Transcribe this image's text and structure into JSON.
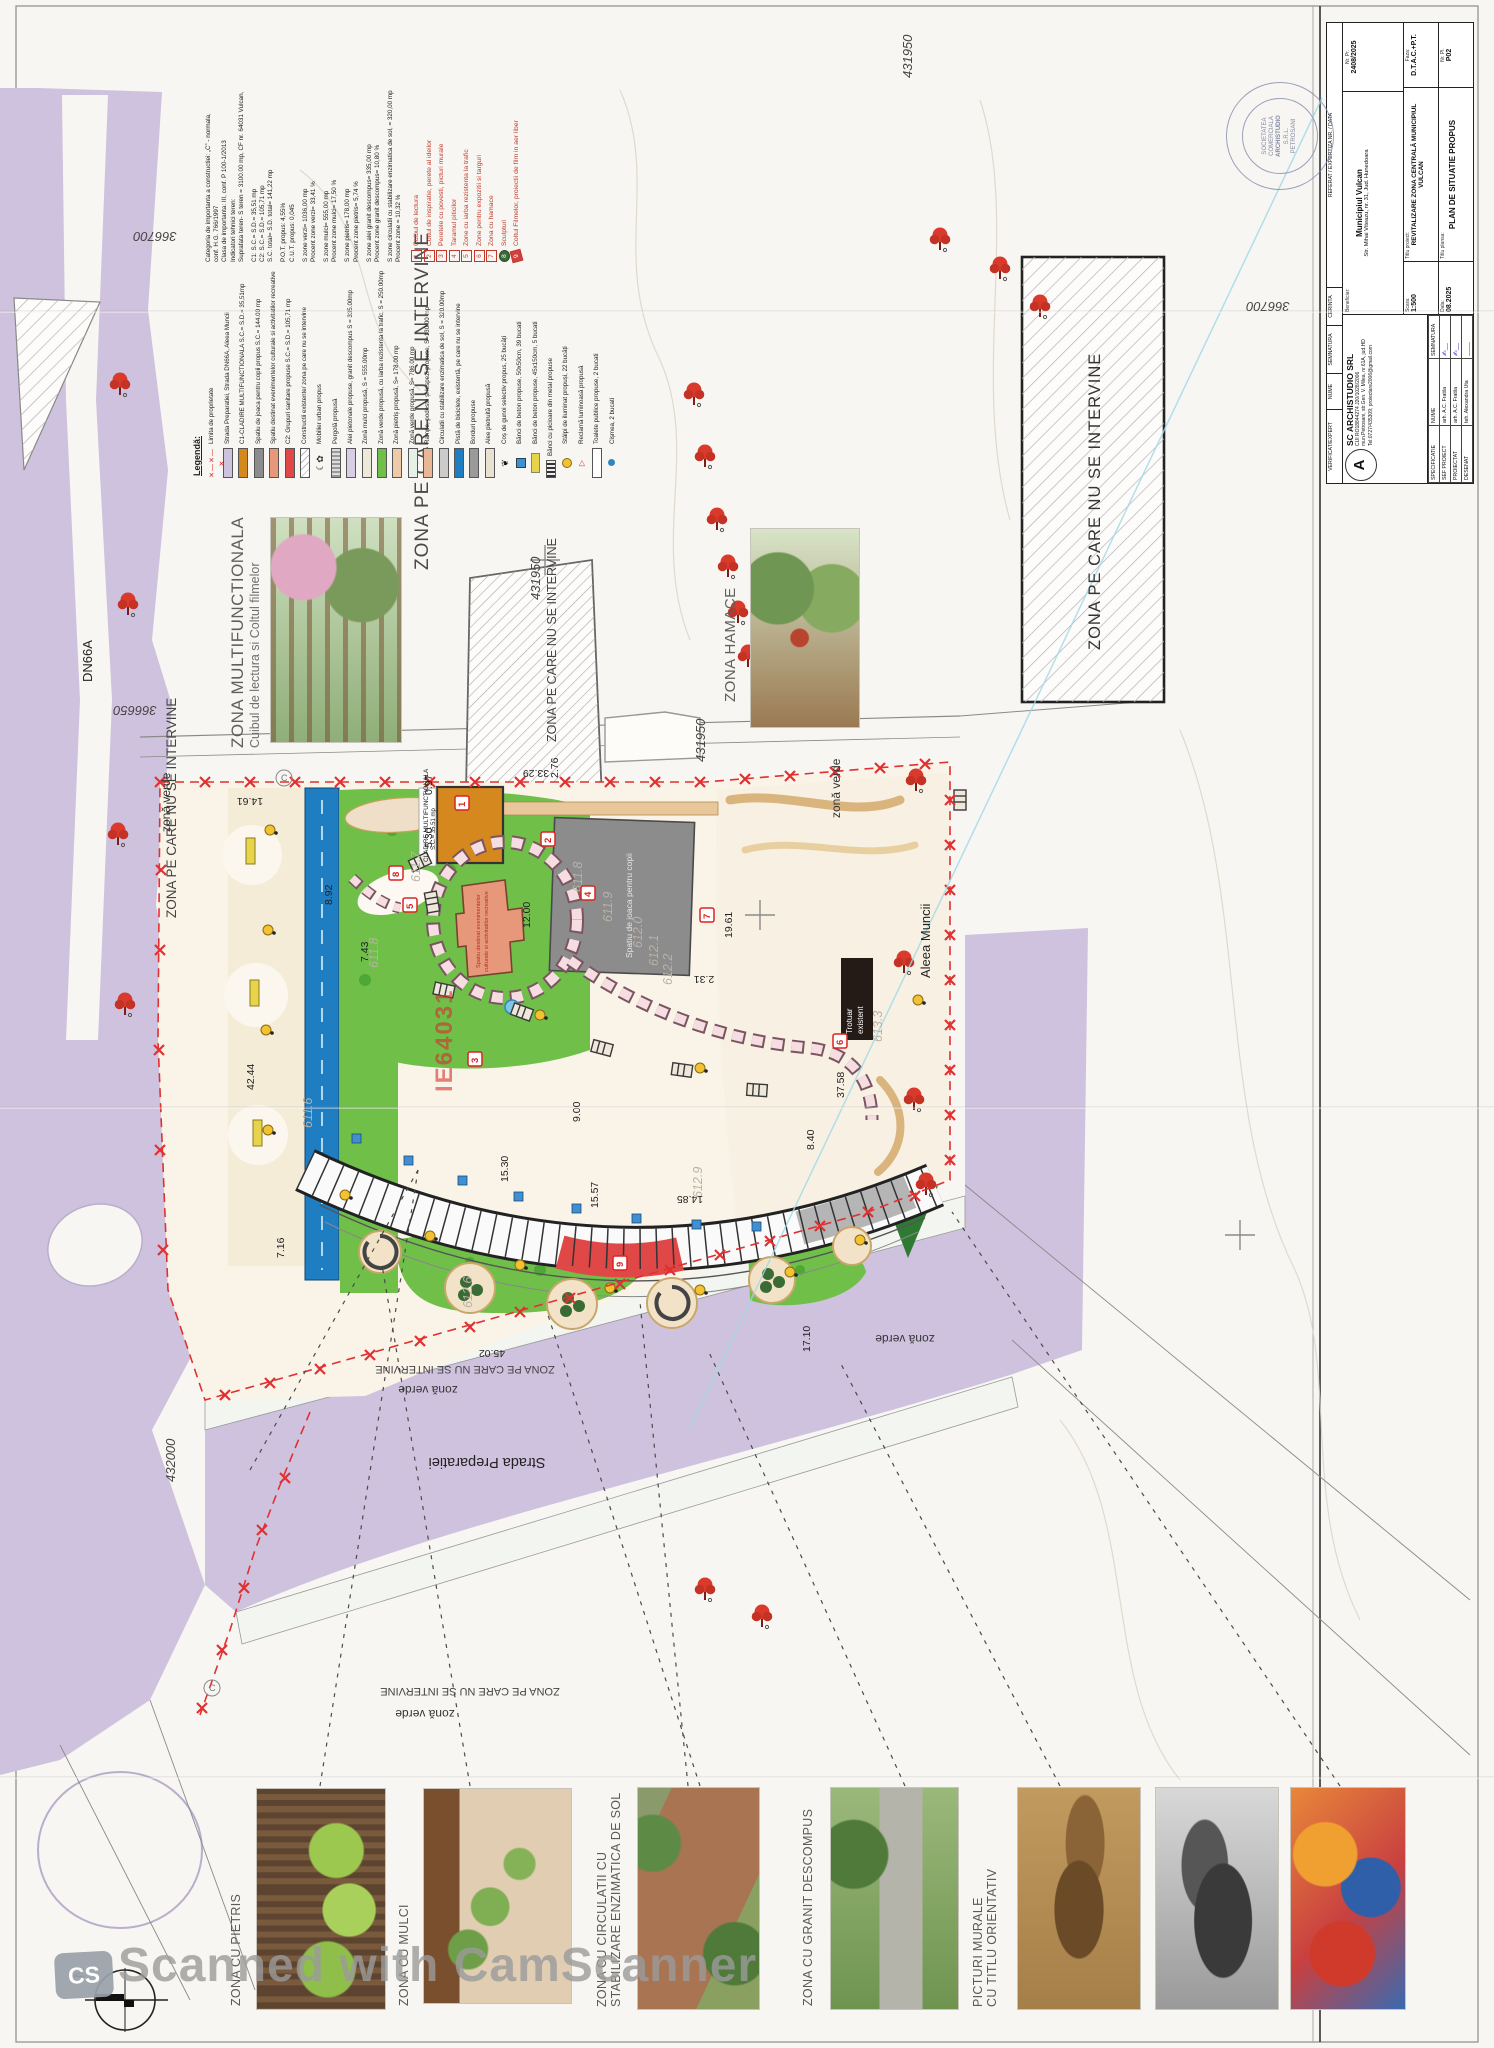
{
  "title_block": {
    "company": "SC ARCHISTUDIO SRL",
    "company_logo": "A",
    "company_id": "CUI RO18844274    J20/1028/2006",
    "company_addr": "mun.Petrosani, str.Gen. V. Milea, nr.61A, jud.HD",
    "company_contact": "Tel:0727/435309; proiectare2006@gmail.com",
    "verificat": "VERIFICAT/EXPERT",
    "nume": "NUME",
    "semnatura": "SEMNATURA",
    "cerinta": "CERINTA",
    "referat": "REFERAT / EXPERTIZA NR. / DATA",
    "specificatie": "SPECIFICATIE",
    "rows": [
      {
        "role": "SEF PROIECT",
        "name": "arh. A.C. Fratila"
      },
      {
        "role": "PROIECTAT",
        "name": "arh. A.C. Fratila"
      },
      {
        "role": "DESENAT",
        "name": "teh. Alexandra Uta"
      }
    ],
    "scara_label": "Scara:",
    "scara": "1:500",
    "data_label": "Data:",
    "data": "08.2025",
    "beneficiar_label": "Beneficiar:",
    "beneficiar": "Municipiul Vulcan",
    "beneficiar_addr": "Str. Mihai Viteazu, nr. 31, Jud. Hunedoara",
    "titlu_proiect_label": "Titlu proiect:",
    "titlu_proiect": "REVITALIZARE ZONA CENTRALĂ MUNICIPIUL VULCAN",
    "titlu_plansa_label": "Titlu plansa:",
    "titlu_plansa": "PLAN DE SITUATIE PROPUS",
    "nr_pr_label": "Nr. Pr.",
    "nr_pr": "2408/2025",
    "faza_label": "Faza:",
    "faza": "D.T.A.C.+P.T.",
    "nr_pl_label": "Nr. Pl.",
    "nr_pl": "P02"
  },
  "stamp": {
    "line1": "SOCIETATEA",
    "line2": "COMERCIALA",
    "line3": "ARCHISTUDIO",
    "line4": "S.R.L.",
    "line5": "PETROSANI"
  },
  "legend": {
    "title": "Legendă:",
    "items": [
      {
        "icon": "boundary",
        "label": "Limita de proprietate"
      },
      {
        "icon": "road",
        "label": "Strada Preparatiei, Strada DN66A, Aleea Muncii"
      },
      {
        "icon": "c1",
        "label": "C1-CLADIRE MULTIFUNCTIONALA S.C.= S.D.= 35,51mp"
      },
      {
        "icon": "play",
        "label": "Spatiu de joaca pentru copii propus S.C.= 144.00 mp"
      },
      {
        "icon": "events",
        "label": "Spatiu destinat evenimentelor culturale si activitatilor recreative"
      },
      {
        "icon": "c2",
        "label": "C2: Grupuri sanitare propuse S.C.= S.D.= 105,71 mp"
      },
      {
        "icon": "existing",
        "label": "Constructii existente/ zona pe care nu se intervine"
      },
      {
        "icon": "furniture",
        "label": "Mobilier urban propus"
      },
      {
        "icon": "pergola",
        "label": "Pergolă propusă"
      },
      {
        "icon": "granite",
        "label": "Alei pietonale propuse, granit descompus S = 335.00mp"
      },
      {
        "icon": "mulch",
        "label": "Zonă mulci propusă, S = 555.00mp"
      },
      {
        "icon": "grass-traffic",
        "label": "Zonă verde propusă, cu iarba rezistenta la trafic, S = 250.00mp"
      },
      {
        "icon": "gravel",
        "label": "Zonă pietriș propusă, S= 178.00 mp"
      },
      {
        "icon": "green",
        "label": "Zonă verde propusă, S= 786.00 mp"
      },
      {
        "icon": "ramps",
        "label": "Rampe, podeste și lespezi propuse, S=130.00 mp"
      },
      {
        "icon": "stabilized",
        "label": "Circulatii cu stabilizare enzimatica de sol, S = 320.00mp"
      },
      {
        "icon": "bike",
        "label": "Pistă de biciclete, existentă, pe care nu se intervine"
      },
      {
        "icon": "curbs",
        "label": "Borduri propuse"
      },
      {
        "icon": "paved",
        "label": "Alee pietruită propusă"
      },
      {
        "icon": "bins",
        "label": "Coș de gunoi selectiv propus, 25 bucăți"
      },
      {
        "icon": "bench-sq",
        "label": "Bănci de beton propuse, 50x50cm, 39 bucati"
      },
      {
        "icon": "bench-long",
        "label": "Bănci de beton propuse, 45x150cm, 5 bucati"
      },
      {
        "icon": "bench-metal",
        "label": "Bănci cu picioare din metal propuse"
      },
      {
        "icon": "lights",
        "label": "Stâlpi de iluminat propuși, 22 bucăți"
      },
      {
        "icon": "sign",
        "label": "Reclamă luminoasă propusă"
      },
      {
        "icon": "toilets",
        "label": "Toalete publice propuse, 2 bucati"
      },
      {
        "icon": "fountain",
        "label": "Cișmea, 2 bucati"
      }
    ],
    "stats": [
      "Categoria de importanta a constructiei: „C” - normala,",
      "conf. H.G. 766/1997",
      "Clasa de importanta: III, conf. P 100-1/2013",
      "Indicatori tehnici teren:",
      "Suprafata teren- S teren = 3100.00 mp, CF nr. 64031 Vulcan,",
      "C1: S.C.= S.D.= 35,51 mp",
      "C2: S.C.= S.D.= 105,71 mp",
      "S.C. total= S.D. total= 141,22 mp",
      "P.O.T. propus: 4,55%",
      "C.U.T. propus: 0,045",
      "S zone verzi= 1036,00 mp",
      "Procent zone verzi= 33,41 %",
      "S zone mulci= 555,00 mp",
      "Procent zone mulci= 17,50 %",
      "S zone pietris= 178,00 mp",
      "Procent zone pietris= 5,74 %",
      "S zone alei granit descompus= 335,00 mp",
      "Procent zone granit descompus= 10,80 %",
      "S zone circulatii cu stabilizare enzimatica de sol, = 320,00 mp",
      "Procent zone = 10,32 %"
    ],
    "numbered": [
      {
        "n": "1",
        "label": "Cuibul de lectura"
      },
      {
        "n": "2",
        "label": "Coltul de inspiratie, perete al ideilor"
      },
      {
        "n": "3",
        "label": "Peretele cu povesti, picturi murale"
      },
      {
        "n": "4",
        "label": "Taramul piticilor"
      },
      {
        "n": "5",
        "label": "Zone cu iarba rezistenta la trafic"
      },
      {
        "n": "6",
        "label": "Zone pentru expozitii si targuri"
      },
      {
        "n": "7",
        "label": "Zona cu hamace"
      },
      {
        "n": "8",
        "label": "Sculpturi"
      },
      {
        "n": "9",
        "label": "Coltul Filmelor, proiectii de film in aer liber"
      }
    ]
  },
  "plan": {
    "zone_labels": {
      "multifunctional_title": "ZONA MULTIFUNCTIONALA",
      "multifunctional_sub": "Cuibul de lectura si Coltul filmelor",
      "hamace": "ZONA HAMACE",
      "no_intervention": "ZONA PE CARE NU SE INTERVINE",
      "green": "zonă verde"
    },
    "streets": {
      "dn66a": "DN66A",
      "preparatiei": "Strada Preparatiei",
      "aleea_muncii": "Aleea Muncii"
    },
    "coordinates": [
      "366700",
      "366650",
      "431950",
      "432000"
    ],
    "cadastral": "IE64031",
    "sidewalk_line1": "Trotuar",
    "sidewalk_line2": "existent",
    "building_c1_line1": "CLADIRE MULTIFUNCTIONALA",
    "building_c1_line2": "S.C.= 35.51 mp",
    "playground_label": "Spatiu de joaca pentru copii",
    "events_label_line1": "Spatiu destinat evenimentelor",
    "events_label_line2": "culturale si activitatilor recreative",
    "markers": [
      "1",
      "2",
      "3",
      "4",
      "5",
      "6",
      "7",
      "8",
      "9"
    ],
    "dimensions": [
      "0.97",
      "5.30",
      "8.92",
      "7.43",
      "14.61",
      "33.29",
      "2.76",
      "12.00",
      "2.31",
      "19.61",
      "9.00",
      "15.30",
      "15.57",
      "14.85",
      "8.40",
      "37.58",
      "42.44",
      "45.02",
      "17.10",
      "7.16"
    ],
    "elevations": [
      "611.7",
      "611.8",
      "611.9",
      "612.0",
      "612.1",
      "612.2",
      "611.6",
      "612.6",
      "612.9",
      "613.3"
    ],
    "circled_c": "C"
  },
  "photos": [
    {
      "label": "ZONA CU PIETRIS"
    },
    {
      "label": "ZONA CU MULCI"
    },
    {
      "label": "ZONA CU CIRCULATII CU",
      "label2": "STABILIZARE ENZIMATICA DE SOL"
    },
    {
      "label": "ZONA CU GRANIT DESCOMPUS"
    },
    {
      "label": "PICTURI MURALE",
      "label2": "CU TITLU ORIENTATIV"
    }
  ],
  "watermark": {
    "text": "Scanned with CamScanner",
    "logo": "CS",
    "north": "N"
  },
  "colors": {
    "road_purple": "#cfc2de",
    "green": "#6fbf49",
    "pale_green": "#e6f0e4",
    "bike_blue": "#1f7ec2",
    "building_orange": "#d4881e",
    "building_salmon": "#e8987a",
    "sanitary_red": "#e04848",
    "boundary_red": "#e03030",
    "gravel_tan": "#edcba8",
    "playground_gray": "#8c8c8c",
    "tree_red": "#d93a2b",
    "lamp_yellow": "#f2c230"
  }
}
